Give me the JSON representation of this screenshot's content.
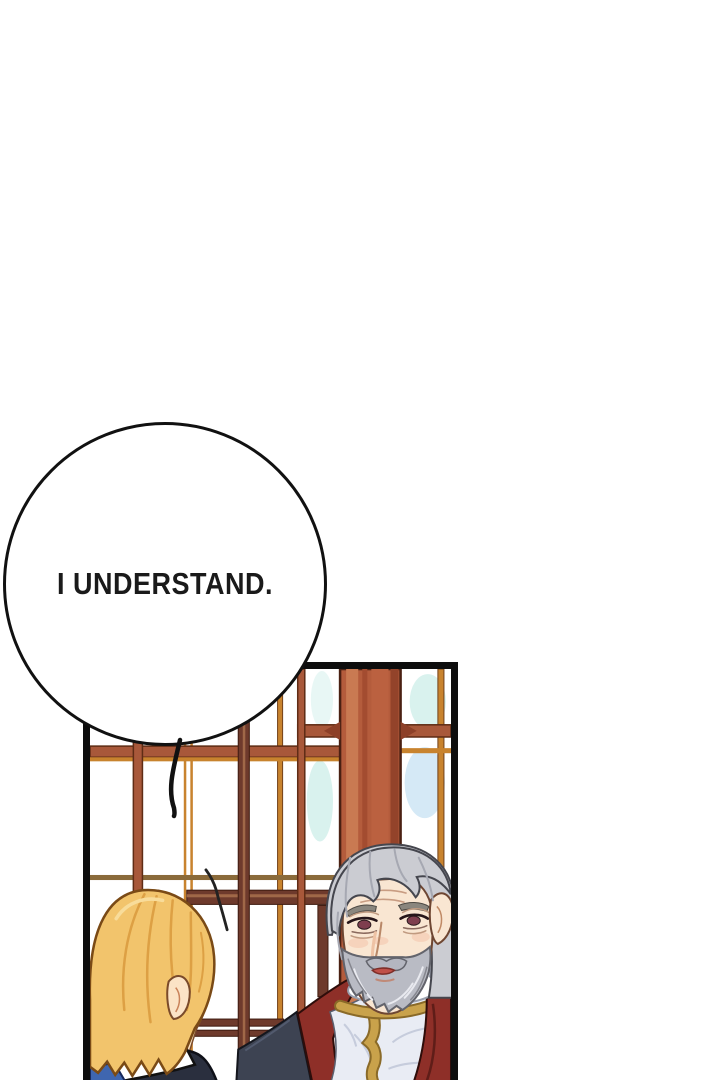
{
  "speech_bubble": {
    "text": "I UNDERSTAND."
  },
  "scene": {
    "description": "comic panel: blond character seen from behind faces an elderly gray-bearded nobleman in front of a wooden lattice window",
    "characters": [
      "blond-character-back-view",
      "old-man-gray-beard"
    ]
  },
  "palette": {
    "paper": "#ffffff",
    "ink": "#111111",
    "panel-border": "#0d0d0d",
    "wood-rail": "#a8583a",
    "wood-mid": "#b45c3c",
    "wood-light": "#c97a52",
    "wood-dark": "#8d4028",
    "wood-outline": "#4a2012",
    "mullion": "#c8832e",
    "mullion-dark": "#74421a",
    "rail-maroon": "#6e3a2c",
    "rail-maroon-hi": "#a06848",
    "gold-accent": "#b3903e",
    "glass-cyan": "#d9f2ee",
    "glass-blue": "#d5e9f6",
    "glass-green": "#e2f4e4",
    "hair-blonde": "#f2c46c",
    "hair-blonde-hi": "#f8dc9a",
    "hair-blonde-shadow": "#dda044",
    "hair-blonde-outline": "#7a4a16",
    "skin": "#fbe3c6",
    "skin-line": "#c9825a",
    "navy": "#2a2f3e",
    "navy-hi": "#3d4356",
    "blue-cloth": "#3f66b0",
    "gray-hair": "#cbccd2",
    "gray-hair-shadow": "#a6a8b2",
    "gray-hair-outline": "#45464e",
    "old-skin": "#f9e6d2",
    "skin-outline": "#6e4632",
    "blush": "#f4c4ab",
    "eye-red": "#7e3e4e",
    "beard": "#b9bbc4",
    "beard-light": "#e9eaf0",
    "beard-dark": "#85868e",
    "lip": "#c05048",
    "tunic": "#e9ecf4",
    "tunic-shadow": "#c6ccdc",
    "gold": "#c9a24b",
    "gold-dark": "#8a6a28",
    "coat": "#8e2f28",
    "coat-dark": "#5f1d18",
    "coat-outline": "#2e0d0a",
    "charcoal": "#3d4352",
    "charcoal-hi": "#525a6e"
  }
}
